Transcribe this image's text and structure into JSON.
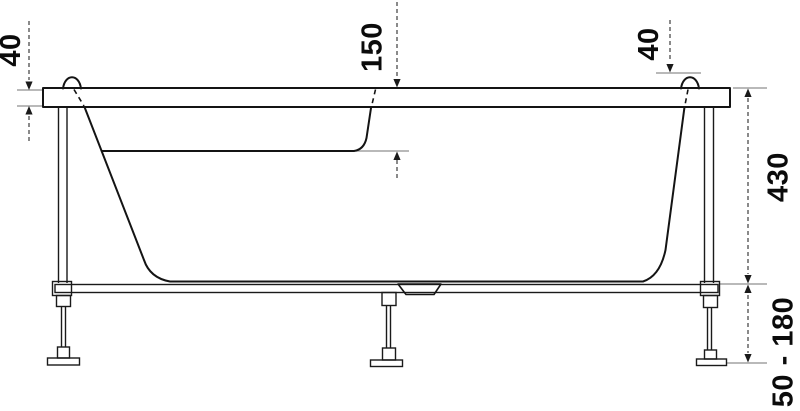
{
  "dimension_labels": {
    "top_left": "40",
    "top_center": "150",
    "top_right": "40",
    "right": "430",
    "bottom_right": "50 - 180"
  },
  "colors": {
    "background": "#ffffff",
    "tub_outline": "#141414",
    "frame_outline": "#1a1a1a",
    "dimension_line": "#3c3c3c",
    "extension_line": "#8f8f8f",
    "label_text": "#0b0b0b"
  }
}
